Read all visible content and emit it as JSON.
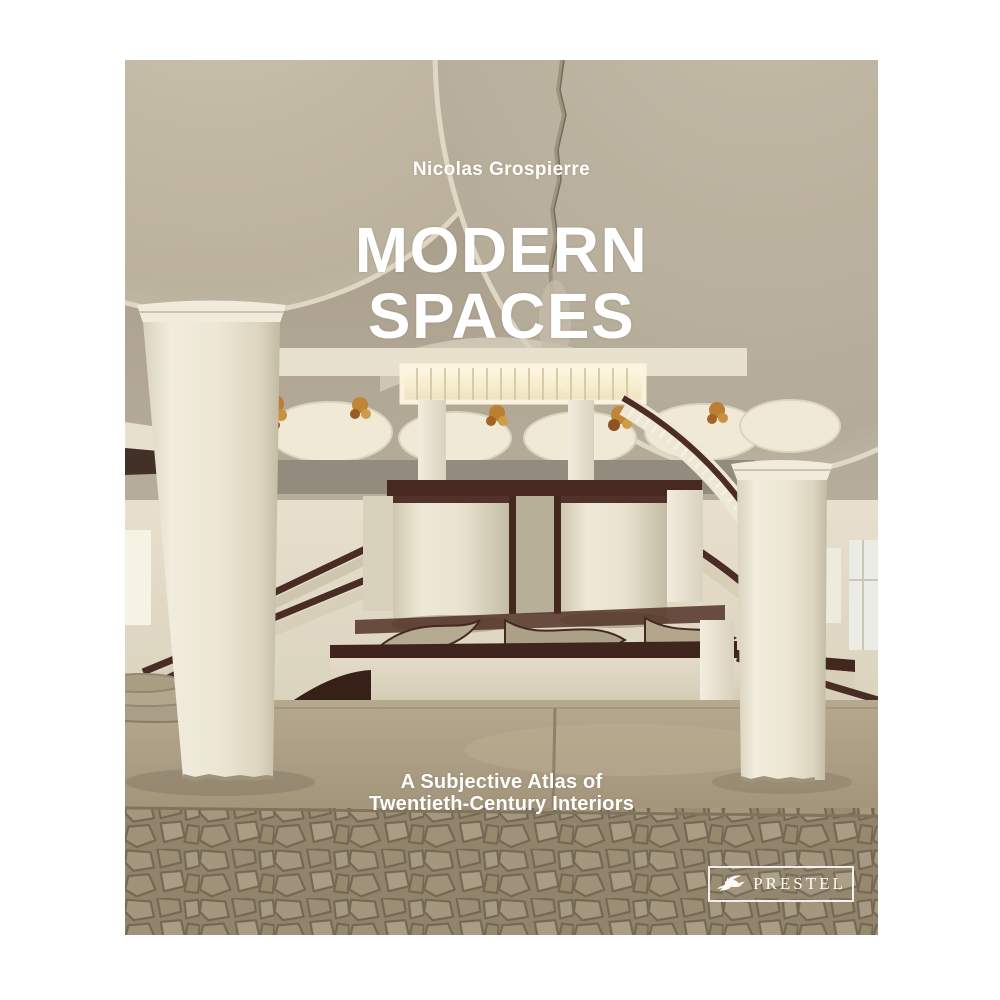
{
  "page": {
    "background_color": "#ffffff"
  },
  "cover": {
    "author": "Nicolas Grospierre",
    "title": {
      "line1": "MODERN",
      "line2": "SPACES"
    },
    "subtitle": {
      "line1": "A Subjective Atlas of",
      "line2": "Twentieth-Century Interiors"
    },
    "publisher": {
      "name": "PRESTEL",
      "icon": "pegasus-icon"
    },
    "text_color": "#ffffff",
    "photo": {
      "description": "Modernist lobby interior: taupe mushroom-slab ceiling with crack, two cream columns, mezzanine with glowing clerestory band, amber chandeliers, hanging cream cylinders with maroon trim, twin staircases with dark maroon rails, smooth concrete floor and crazy-paving stone mosaic",
      "palette": {
        "ceiling_taupe": "#a89f8c",
        "dome_cream": "#cfc9b5",
        "column_cream": "#ece7d5",
        "wall_cream": "#e5deca",
        "rail_maroon": "#42241e",
        "chandelier_amber": "#b97c2c",
        "clerestory_light": "#fdf6dc",
        "floor_tan": "#a79878",
        "mosaic_base": "#8f826a",
        "mosaic_grout": "#6e6351"
      }
    }
  }
}
